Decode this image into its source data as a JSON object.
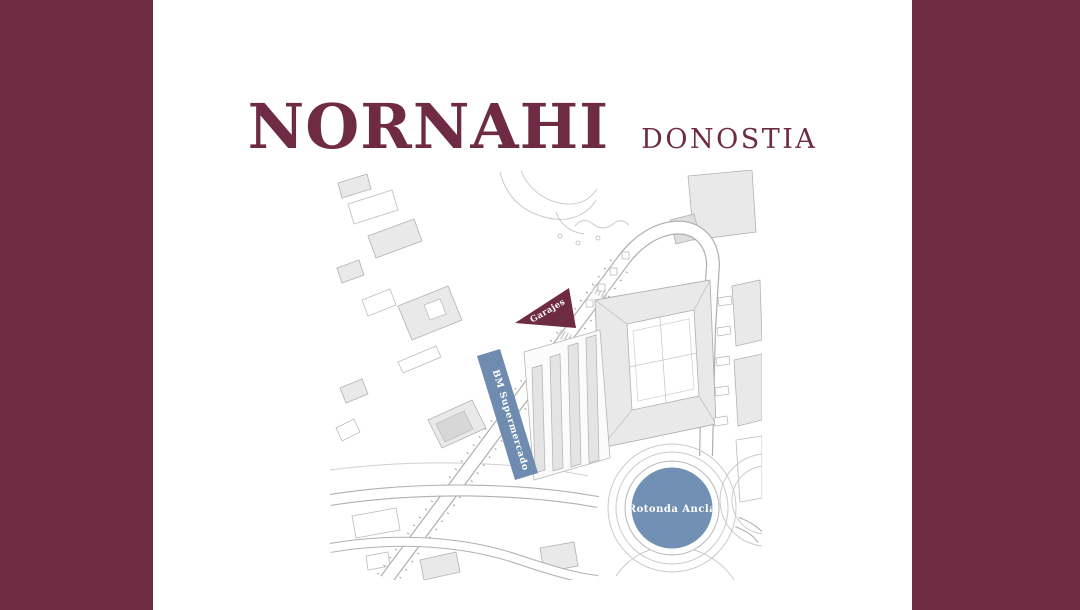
{
  "branding": {
    "title": "NORNAHI",
    "subtitle": "DONOSTIA",
    "title_color": "#6f2b44"
  },
  "frame": {
    "color": "#6e2c42"
  },
  "map": {
    "description": "architectural site plan",
    "line_color": "#b4b4b4",
    "building_fill": "#e9e9e9",
    "labels": [
      {
        "id": "garajes",
        "text": "Garajes",
        "fill": "#6e2c42",
        "text_color": "#ffffff"
      },
      {
        "id": "bm-supermercado",
        "text": "BM Supermercado",
        "fill": "#6f8cb0",
        "text_color": "#ffffff"
      },
      {
        "id": "rotonda-ancla",
        "text": "Rotonda Ancla",
        "fill": "#7190b3",
        "text_color": "#ffffff"
      }
    ]
  }
}
